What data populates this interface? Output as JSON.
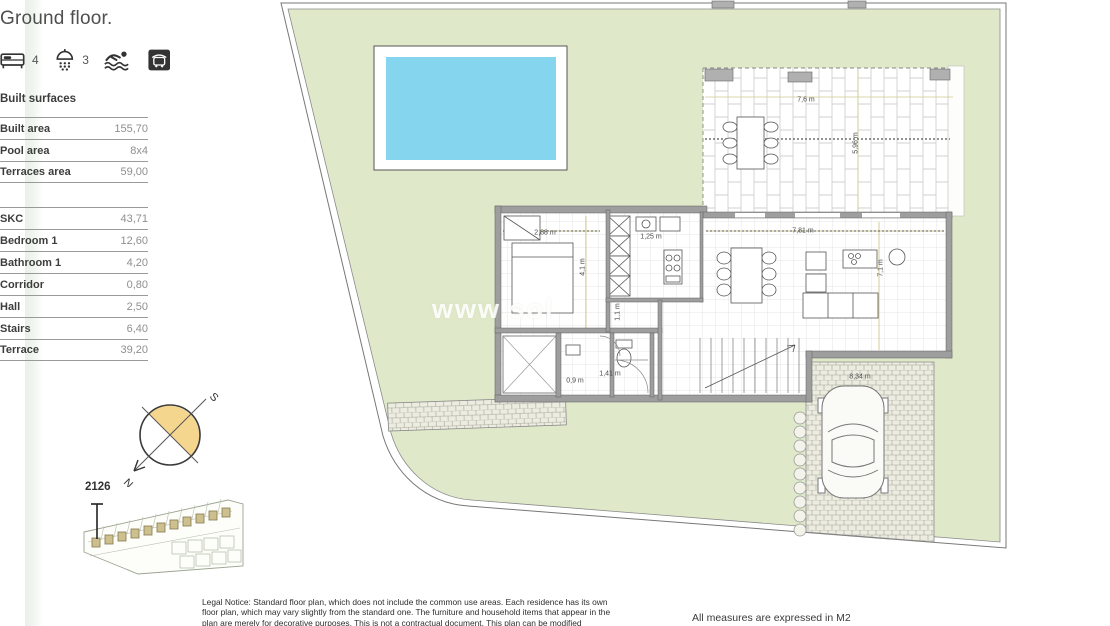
{
  "header": {
    "title": "Ground floor."
  },
  "features": {
    "bedrooms": "4",
    "bathrooms": "3"
  },
  "surfaces": {
    "heading": "Built surfaces",
    "main": [
      {
        "label": "Built area",
        "value": "155,70"
      },
      {
        "label": "Pool area",
        "value": "8x4"
      },
      {
        "label": "Terraces area",
        "value": "59,00"
      }
    ],
    "rooms": [
      {
        "label": "SKC",
        "value": "43,71"
      },
      {
        "label": "Bedroom 1",
        "value": "12,60"
      },
      {
        "label": "Bathroom 1",
        "value": "4,20"
      },
      {
        "label": "Corridor",
        "value": "0,80"
      },
      {
        "label": "Hall",
        "value": "2,50"
      },
      {
        "label": "Stairs",
        "value": "6,40"
      },
      {
        "label": "Terrace",
        "value": "39,20"
      }
    ]
  },
  "compass": {
    "north": "N",
    "south": "S"
  },
  "sitemap": {
    "unit": "2126"
  },
  "plan": {
    "watermark": "www.sol",
    "dims": {
      "terrace_width": "7,6 m",
      "terrace_depth": "5,96 m",
      "bedroom_width": "2,88 m",
      "kitchen_width": "1,25 m",
      "bedroom_depth": "4,1 m",
      "living_width": "7,81 m",
      "living_depth": "7,1 m",
      "hall_depth": "1,1 m",
      "path_width": "0,9 m",
      "hall_width": "1,41 m",
      "driveway_length": "8,34 m"
    }
  },
  "footer": {
    "legal_notice": "Legal Notice: Standard floor plan, which does not include the common use areas. Each residence has its own floor plan, which may vary slightly from the standard one. The furniture and household items that appear in the plan are merely for decorative purposes. This is not a contractual document. This plan can be modified",
    "measures_note": "All measures are expressed in M2"
  },
  "colors": {
    "garden": "#dfe9ca",
    "pool": "#85d5ee",
    "compass_fill": "#f4d68e",
    "sitemap_house": "#cdc08e"
  }
}
